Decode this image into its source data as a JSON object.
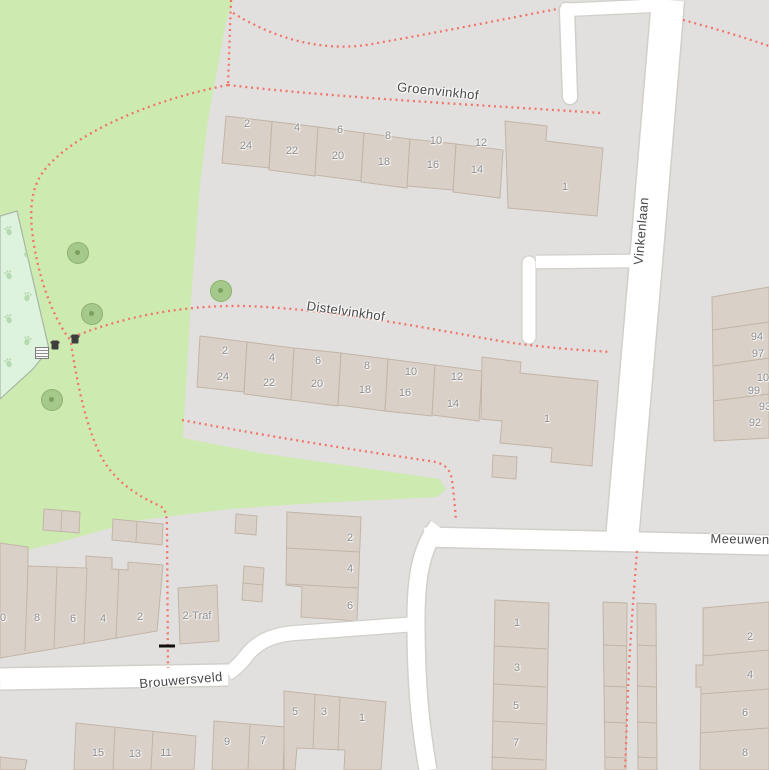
{
  "map": {
    "colors": {
      "residential": "#e1e0de",
      "grass": "#cdeab0",
      "dog_park": "#def3de",
      "dog_park_paws": "#b7dbb1",
      "building": "#d9d0c8",
      "building_outline": "#c2b5a6",
      "road": "#ffffff",
      "road_casing": "#d2cfca",
      "footpath_dots": "#f2756b"
    },
    "street_labels": [
      {
        "name": "Groenvinkhof",
        "x": 438,
        "y": 91,
        "rotation": 6
      },
      {
        "name": "Distelvinkhof",
        "x": 346,
        "y": 311,
        "rotation": 8
      },
      {
        "name": "Vinkenlaan",
        "x": 641,
        "y": 231,
        "rotation": -85
      },
      {
        "name": "Meeuwen",
        "x": 740,
        "y": 539,
        "rotation": 1
      },
      {
        "name": "Brouwersveld",
        "x": 181,
        "y": 680,
        "rotation": -5
      }
    ],
    "poi_labels": [
      {
        "label": "2-Traf",
        "x": 197,
        "y": 616
      }
    ],
    "house_numbers": {
      "groenvinkhof_front": [
        {
          "label": "2",
          "x": 247,
          "y": 124
        },
        {
          "label": "4",
          "x": 297,
          "y": 128
        },
        {
          "label": "6",
          "x": 340,
          "y": 130
        },
        {
          "label": "8",
          "x": 388,
          "y": 136
        },
        {
          "label": "10",
          "x": 436,
          "y": 141
        },
        {
          "label": "12",
          "x": 481,
          "y": 143
        }
      ],
      "groenvinkhof_back": [
        {
          "label": "24",
          "x": 246,
          "y": 146
        },
        {
          "label": "22",
          "x": 292,
          "y": 151
        },
        {
          "label": "20",
          "x": 338,
          "y": 156
        },
        {
          "label": "18",
          "x": 384,
          "y": 162
        },
        {
          "label": "16",
          "x": 433,
          "y": 165
        },
        {
          "label": "14",
          "x": 477,
          "y": 170
        },
        {
          "label": "1",
          "x": 565,
          "y": 187
        }
      ],
      "distelvinkhof_front": [
        {
          "label": "2",
          "x": 225,
          "y": 351
        },
        {
          "label": "4",
          "x": 272,
          "y": 358
        },
        {
          "label": "6",
          "x": 318,
          "y": 361
        },
        {
          "label": "8",
          "x": 367,
          "y": 366
        },
        {
          "label": "10",
          "x": 411,
          "y": 372
        },
        {
          "label": "12",
          "x": 457,
          "y": 377
        }
      ],
      "distelvinkhof_back": [
        {
          "label": "24",
          "x": 223,
          "y": 377
        },
        {
          "label": "22",
          "x": 269,
          "y": 383
        },
        {
          "label": "20",
          "x": 317,
          "y": 384
        },
        {
          "label": "18",
          "x": 365,
          "y": 390
        },
        {
          "label": "16",
          "x": 405,
          "y": 393
        },
        {
          "label": "14",
          "x": 453,
          "y": 404
        },
        {
          "label": "1",
          "x": 547,
          "y": 419
        }
      ],
      "vinkenlaan_east_block": [
        {
          "label": "94",
          "x": 757,
          "y": 337
        },
        {
          "label": "97",
          "x": 758,
          "y": 354
        },
        {
          "label": "10",
          "x": 763,
          "y": 378
        },
        {
          "label": "99",
          "x": 754,
          "y": 391
        },
        {
          "label": "93",
          "x": 765,
          "y": 407
        },
        {
          "label": "92",
          "x": 755,
          "y": 423
        }
      ],
      "brouwersveld_north": [
        {
          "label": "0",
          "x": 3,
          "y": 618
        },
        {
          "label": "8",
          "x": 37,
          "y": 618
        },
        {
          "label": "6",
          "x": 73,
          "y": 619
        },
        {
          "label": "4",
          "x": 103,
          "y": 619
        },
        {
          "label": "2",
          "x": 140,
          "y": 617
        }
      ],
      "center_block": [
        {
          "label": "2",
          "x": 350,
          "y": 538
        },
        {
          "label": "4",
          "x": 350,
          "y": 569
        },
        {
          "label": "6",
          "x": 350,
          "y": 606
        }
      ],
      "brouwersveld_south": [
        {
          "label": "15",
          "x": 98,
          "y": 753
        },
        {
          "label": "13",
          "x": 135,
          "y": 754
        },
        {
          "label": "11",
          "x": 166,
          "y": 753
        },
        {
          "label": "9",
          "x": 227,
          "y": 742
        },
        {
          "label": "7",
          "x": 263,
          "y": 741
        },
        {
          "label": "5",
          "x": 295,
          "y": 712
        },
        {
          "label": "3",
          "x": 324,
          "y": 712
        },
        {
          "label": "1",
          "x": 362,
          "y": 718
        }
      ],
      "southeast_col_a": [
        {
          "label": "1",
          "x": 517,
          "y": 623
        },
        {
          "label": "3",
          "x": 517,
          "y": 668
        },
        {
          "label": "5",
          "x": 516,
          "y": 706
        },
        {
          "label": "7",
          "x": 516,
          "y": 743
        }
      ],
      "southeast_col_c": [
        {
          "label": "2",
          "x": 750,
          "y": 637
        },
        {
          "label": "4",
          "x": 750,
          "y": 675
        },
        {
          "label": "6",
          "x": 745,
          "y": 713
        },
        {
          "label": "8",
          "x": 745,
          "y": 753
        }
      ]
    },
    "features": {
      "trees": [
        {
          "x": 78,
          "y": 253
        },
        {
          "x": 92,
          "y": 314
        },
        {
          "x": 52,
          "y": 400
        },
        {
          "x": 221,
          "y": 291
        }
      ],
      "waste_bins": [
        {
          "x": 55,
          "y": 345
        },
        {
          "x": 75,
          "y": 339
        }
      ],
      "picnic_table": {
        "x": 42,
        "y": 353
      },
      "gate": {
        "x": 167,
        "y": 646
      }
    }
  }
}
